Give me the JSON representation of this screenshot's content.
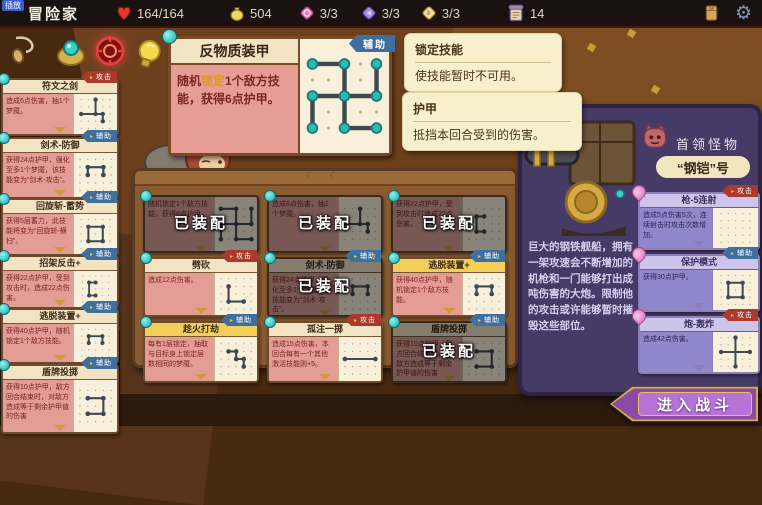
{
  "topbar": {
    "record_badge": "插放",
    "player_name": "冒险家",
    "hp": "164/164",
    "gold": "504",
    "relic1": "3/3",
    "relic2": "3/3",
    "relic3": "3/3",
    "deck_count": "14"
  },
  "colors": {
    "tag_attack": "#a93a2c",
    "tag_support": "#3e6f9d",
    "highlight_text": "#e09a20",
    "accent_gold": "#d8a83c",
    "panel_purple": "#463a66"
  },
  "preview": {
    "title": "反物质装甲",
    "tag": "辅助",
    "desc_pre": "随机",
    "desc_hl": "锁定",
    "desc_post": "1个敌方技能，获得6点护甲。",
    "pattern": [
      [
        2,
        0,
        2,
        2
      ],
      [
        2,
        0,
        0,
        0
      ],
      [
        2,
        2,
        4,
        2
      ],
      [
        4,
        2,
        4,
        0
      ],
      [
        2,
        2,
        2,
        4
      ],
      [
        2,
        4,
        4,
        4
      ],
      [
        2,
        2,
        0,
        2
      ],
      [
        0,
        2,
        0,
        4
      ]
    ]
  },
  "tooltips": [
    {
      "title": "锁定技能",
      "body": "使技能暂时不可用。"
    },
    {
      "title": "护甲",
      "body": "抵挡本回合受到的伤害。"
    }
  ],
  "sidebar": {
    "cards": [
      {
        "title": "符文之剑",
        "tag": "攻击",
        "desc": "造成6点伤害，抽1个梦魇。",
        "pattern": [
          [
            2,
            0,
            2,
            2
          ],
          [
            0,
            2,
            3,
            2
          ],
          [
            3,
            2,
            3,
            3
          ]
        ]
      },
      {
        "title": "剑术-防御",
        "tag": "辅助",
        "desc": "获得24点护甲，强化至多1个梦魇，该技能变为“剑术-攻击”。",
        "pattern": [
          [
            1,
            1,
            3,
            1
          ],
          [
            3,
            1,
            3,
            2
          ],
          [
            1,
            1,
            1,
            2
          ]
        ]
      },
      {
        "title": "回旋斩-蓄势",
        "tag": "辅助",
        "desc": "获得5层蓄力，此技能将变为“回旋斩-横扫”。",
        "pattern": [
          [
            1,
            1,
            3,
            1
          ],
          [
            3,
            1,
            3,
            3
          ],
          [
            1,
            3,
            3,
            3
          ],
          [
            1,
            1,
            1,
            3
          ]
        ]
      },
      {
        "title": "招架反击+",
        "tag": "辅助",
        "desc": "获得22点护甲，受到攻击时，造成22点伤害。",
        "pattern": [
          [
            2,
            1,
            1,
            1
          ],
          [
            1,
            1,
            1,
            3
          ],
          [
            1,
            3,
            2,
            3
          ]
        ]
      },
      {
        "title": "逃脱装置+",
        "tag": "辅助",
        "desc": "获得40点护甲，随机锁定1个敌方技能。",
        "pattern": [
          [
            1,
            2,
            1,
            1
          ],
          [
            1,
            1,
            3,
            1
          ],
          [
            3,
            1,
            3,
            2
          ]
        ]
      },
      {
        "title": "盾牌投掷",
        "tag": "辅助",
        "desc": "获得10点护甲，敌方回合结束时，对敌方造成等于剩余护甲值的伤害",
        "pattern": [
          [
            1,
            1,
            3,
            1
          ],
          [
            3,
            1,
            3,
            3
          ],
          [
            1,
            3,
            3,
            3
          ]
        ]
      }
    ]
  },
  "loadout": {
    "equipped_label": "已装配",
    "cards": [
      {
        "desc": "随机锁定1个敌方技能，获得6点护甲。",
        "pattern": [
          [
            2,
            0,
            2,
            2
          ],
          [
            2,
            0,
            0,
            0
          ],
          [
            2,
            2,
            4,
            2
          ],
          [
            4,
            2,
            4,
            0
          ],
          [
            2,
            2,
            2,
            4
          ],
          [
            2,
            4,
            4,
            4
          ],
          [
            2,
            2,
            0,
            2
          ],
          [
            0,
            2,
            0,
            4
          ]
        ]
      },
      {
        "desc": "造成6点伤害，抽1个梦魇。",
        "pattern": [
          [
            2,
            0,
            2,
            2
          ],
          [
            0,
            2,
            3,
            2
          ],
          [
            3,
            2,
            3,
            3
          ]
        ]
      },
      {
        "desc": "获得22点护甲，受到攻击时造成22点伤害。",
        "pattern": [
          [
            2,
            1,
            1,
            1
          ],
          [
            1,
            1,
            1,
            3
          ],
          [
            1,
            3,
            2,
            3
          ]
        ]
      },
      {
        "title": "劈砍",
        "tag": "攻击",
        "desc": "造成12点伤害。",
        "pattern": [
          [
            1,
            1,
            1,
            3
          ],
          [
            1,
            3,
            3,
            3
          ]
        ]
      },
      {
        "title": "剑术-防御",
        "tag": "辅助",
        "desc": "获得24点护甲，强化至多1个梦魇，该技能变为“剑术-攻击”。",
        "pattern": [
          [
            1,
            1,
            3,
            1
          ],
          [
            3,
            1,
            3,
            2
          ],
          [
            1,
            1,
            1,
            2
          ]
        ]
      },
      {
        "title": "逃脱装置+",
        "tag": "辅助",
        "desc": "获得40点护甲，随机锁定1个敌方技能。",
        "pattern": [
          [
            1,
            2,
            1,
            1
          ],
          [
            1,
            1,
            3,
            1
          ],
          [
            3,
            1,
            3,
            2
          ]
        ]
      },
      {
        "title": "趁火打劫",
        "tag": "辅助",
        "desc": "每有1层锁定，抽取与目标身上锁定层数相同的梦魇。",
        "pattern": [
          [
            1,
            1,
            2,
            1
          ],
          [
            2,
            1,
            2,
            2
          ],
          [
            2,
            2,
            3,
            2
          ],
          [
            3,
            2,
            3,
            3
          ]
        ]
      },
      {
        "title": "孤注一掷",
        "tag": "攻击",
        "desc": "造成15点伤害，本回合每有一个其他激活技能则+5。",
        "pattern": [
          [
            0,
            2,
            4,
            2
          ]
        ]
      },
      {
        "title": "盾牌投掷",
        "tag": "辅助",
        "desc": "获得10点护甲，敌方回合结束时，对敌方造成等于剩余护甲值的伤害",
        "pattern": [
          [
            1,
            1,
            3,
            1
          ],
          [
            3,
            1,
            3,
            3
          ],
          [
            1,
            3,
            3,
            3
          ]
        ]
      }
    ]
  },
  "boss": {
    "type_label": "首领怪物",
    "name": "“钢铠”号",
    "desc": "巨大的钢铁舰船，拥有一架攻速会不断增加的机枪和一门能够打出成吨伤害的大炮。限制他的攻击或许能够暂时摧毁这些部位。",
    "skills": [
      {
        "title": "枪-5连射",
        "tag": "攻击",
        "desc": "造成5点伤害5次，连续射击时攻击次数增加。",
        "pattern": []
      },
      {
        "title": "保护模式",
        "tag": "辅助",
        "desc": "获得30点护甲。",
        "pattern": [
          [
            1,
            1,
            3,
            1
          ],
          [
            3,
            1,
            3,
            3
          ],
          [
            1,
            3,
            3,
            3
          ],
          [
            1,
            1,
            1,
            3
          ]
        ]
      },
      {
        "title": "炮-轰炸",
        "tag": "攻击",
        "desc": "造成42点伤害。",
        "pattern": [
          [
            2,
            0,
            2,
            4
          ],
          [
            0,
            2,
            4,
            2
          ]
        ]
      }
    ]
  },
  "battle_button_label": "进入战斗"
}
